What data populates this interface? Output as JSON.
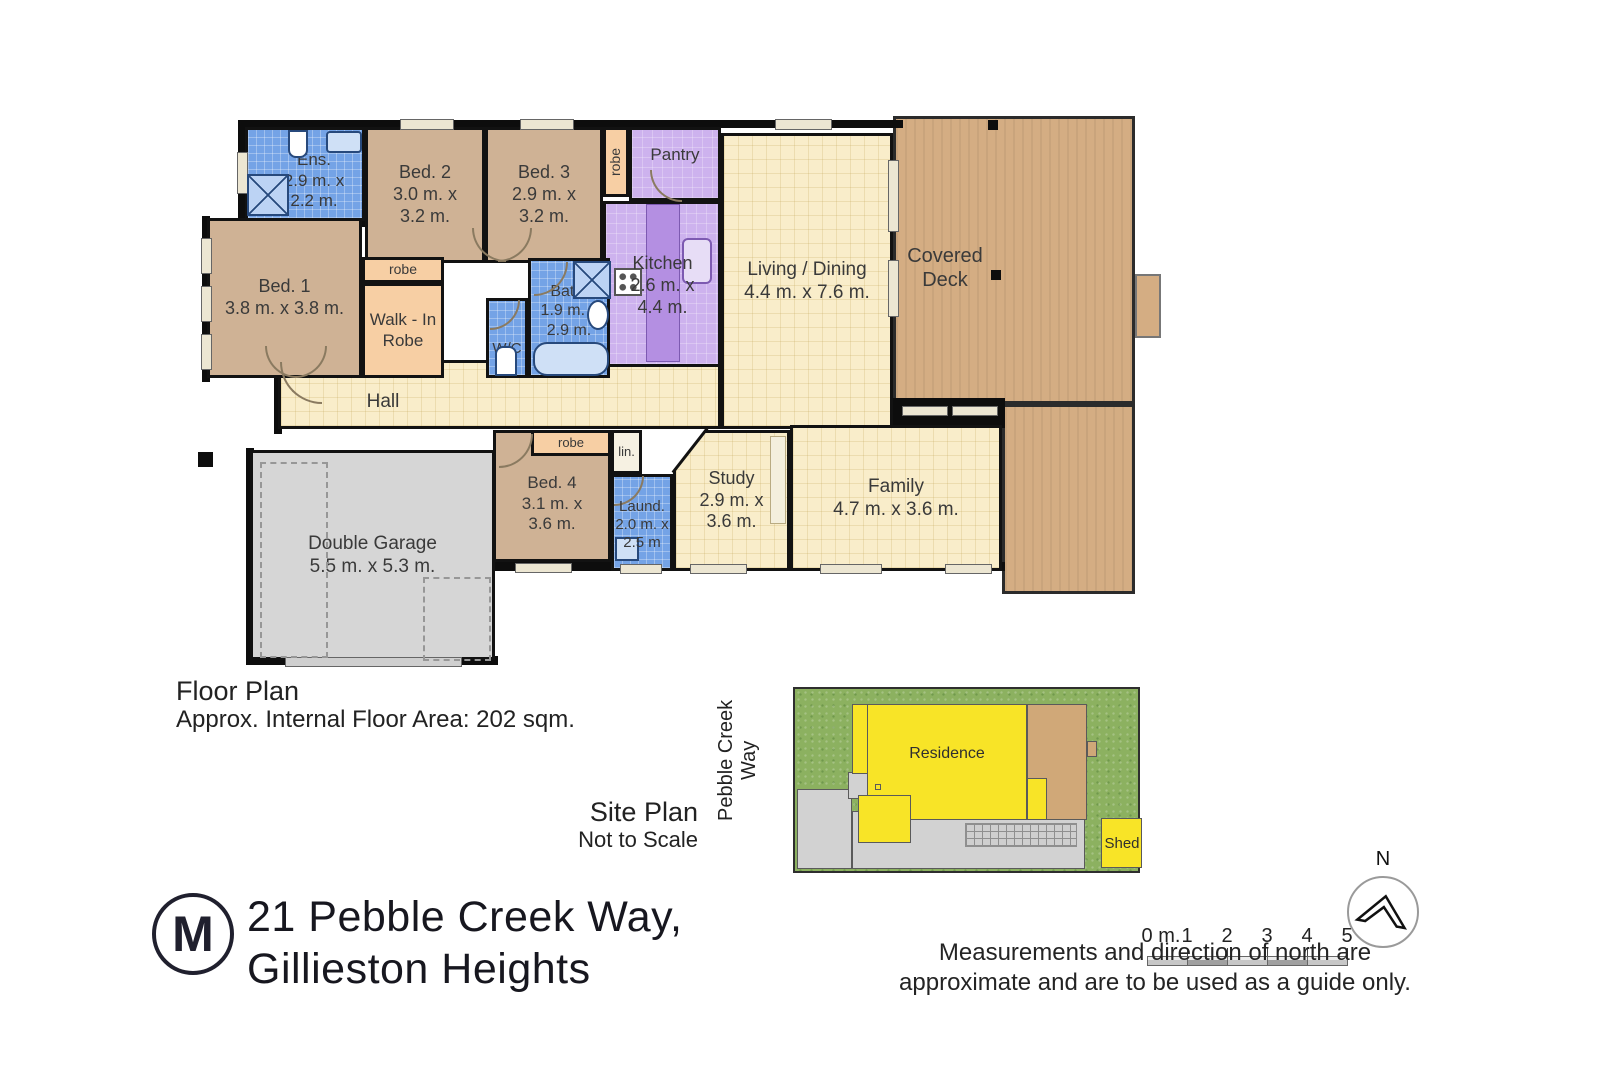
{
  "floor_plan": {
    "title": "Floor Plan",
    "subtitle": "Approx. Internal Floor Area: 202 sqm.",
    "rooms": {
      "ens": "Ens.\n2.9 m. x\n2.2 m.",
      "bed2": "Bed. 2\n3.0 m. x\n3.2 m.",
      "bed3": "Bed. 3\n2.9 m. x\n3.2 m.",
      "robe_top": "robe",
      "pantry": "Pantry",
      "kitchen": "Kitchen\n2.6 m. x\n4.4 m.",
      "living": "Living / Dining\n4.4 m. x 7.6 m.",
      "deck": "Covered\nDeck",
      "bed1": "Bed. 1\n3.8 m. x 3.8 m.",
      "robe_mid": "robe",
      "walk_in_robe": "Walk - In\nRobe",
      "wc": "W/C",
      "bath": "Bath.\n1.9 m. x\n2.9 m.",
      "hall": "Hall",
      "garage": "Double Garage\n5.5 m. x 5.3 m.",
      "bed4": "Bed. 4\n3.1 m. x\n3.6 m.",
      "robe_bed4": "robe",
      "linen": "lin.",
      "laundry": "Laund.\n2.0 m. x\n2.5 m",
      "study": "Study\n2.9 m. x\n3.6 m.",
      "family": "Family\n4.7 m. x 3.6 m."
    }
  },
  "site_plan": {
    "title": "Site Plan",
    "subtitle": "Not to Scale",
    "street": "Pebble Creek Way",
    "residence": "Residence",
    "shed": "Shed"
  },
  "scale_bar": {
    "labels": [
      "0 m.",
      "1",
      "2",
      "3",
      "4",
      "5"
    ]
  },
  "north_arrow": {
    "label": "N"
  },
  "disclaimer": "Measurements and direction of north are\napproximate and are to be used as a guide only.",
  "branding": {
    "logo_letter": "M",
    "address_line1": "21 Pebble Creek Way,",
    "address_line2": "Gillieston Heights"
  },
  "colors": {
    "wall": "#121212",
    "bedroom_tan": "#cfb295",
    "wet_area_blue": "#74a3e6",
    "robe_peach": "#f7cfa4",
    "kitchen_purple": "#cdb2ee",
    "counter_purple": "#b48fe2",
    "floor_cream": "#f9edca",
    "deck_tan": "#d4ad83",
    "garage_gray": "#d6d6d6",
    "site_green": "#8cb160",
    "residence_yellow": "#f8e427",
    "driveway_gray": "#d2d2d2",
    "brand_navy": "#20202e"
  }
}
